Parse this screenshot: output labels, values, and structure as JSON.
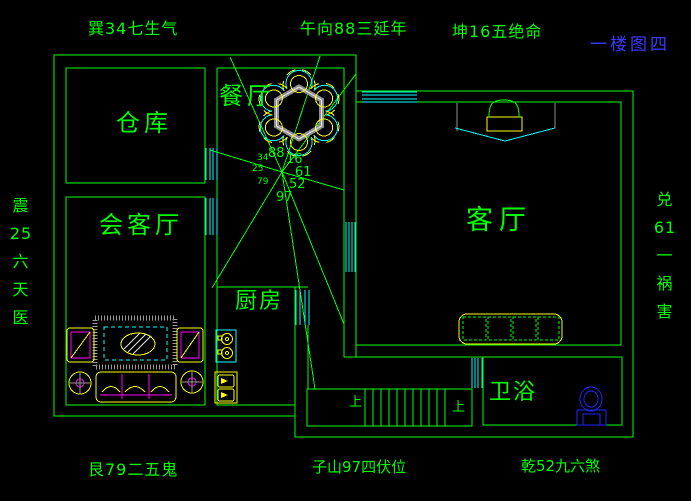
{
  "drawing": {
    "title": "一楼图四",
    "compass": {
      "top_left": "巽34七生气",
      "top_center": "午向88三延年",
      "top_right": "坤16五绝命",
      "left_vertical": "震\n25\n六\n天\n医",
      "right_vertical": "兑\n61\n一\n祸\n害",
      "bottom_left": "艮79二五鬼",
      "bottom_center": "子山97四伏位",
      "bottom_right": "乾52九六煞"
    },
    "rooms": {
      "storage": "仓库",
      "dining": "餐厅",
      "reception": "会客厅",
      "kitchen": "厨房",
      "living": "客厅",
      "bath": "卫浴"
    },
    "flying_stars": {
      "n": "88",
      "ne": "16",
      "e": "61",
      "se": "52",
      "s": "97",
      "nw": "34",
      "w": "25",
      "sw": "79"
    },
    "stairs": {
      "up_label_1": "上",
      "up_label_2": "上"
    },
    "colors": {
      "wall": "#00ff00",
      "window": "#00ffff",
      "furniture": "#ffff00",
      "accent": "#ff00ff",
      "fixture_blue": "#2222ff",
      "title_blue": "#3a3aff"
    }
  }
}
